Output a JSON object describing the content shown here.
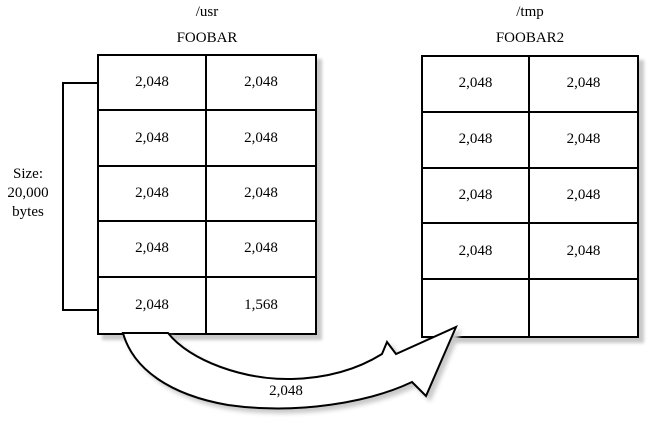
{
  "diagram": {
    "left": {
      "mount_label": "/usr",
      "file_label": "FOOBAR",
      "size_annotation": {
        "lines": [
          "Size:",
          "20,000",
          "bytes"
        ]
      },
      "blocks": [
        [
          "2,048",
          "2,048"
        ],
        [
          "2,048",
          "2,048"
        ],
        [
          "2,048",
          "2,048"
        ],
        [
          "2,048",
          "2,048"
        ],
        [
          "2,048",
          "1,568"
        ]
      ]
    },
    "right": {
      "mount_label": "/tmp",
      "file_label": "FOOBAR2",
      "blocks": [
        [
          "2,048",
          "2,048"
        ],
        [
          "2,048",
          "2,048"
        ],
        [
          "2,048",
          "2,048"
        ],
        [
          "2,048",
          "2,048"
        ],
        [
          "",
          ""
        ]
      ]
    },
    "copy_arrow": {
      "label": "2,048"
    },
    "colors": {
      "line": "#000000",
      "shadow": "#c9c9c9",
      "text": "#000000",
      "background": "#ffffff"
    }
  }
}
